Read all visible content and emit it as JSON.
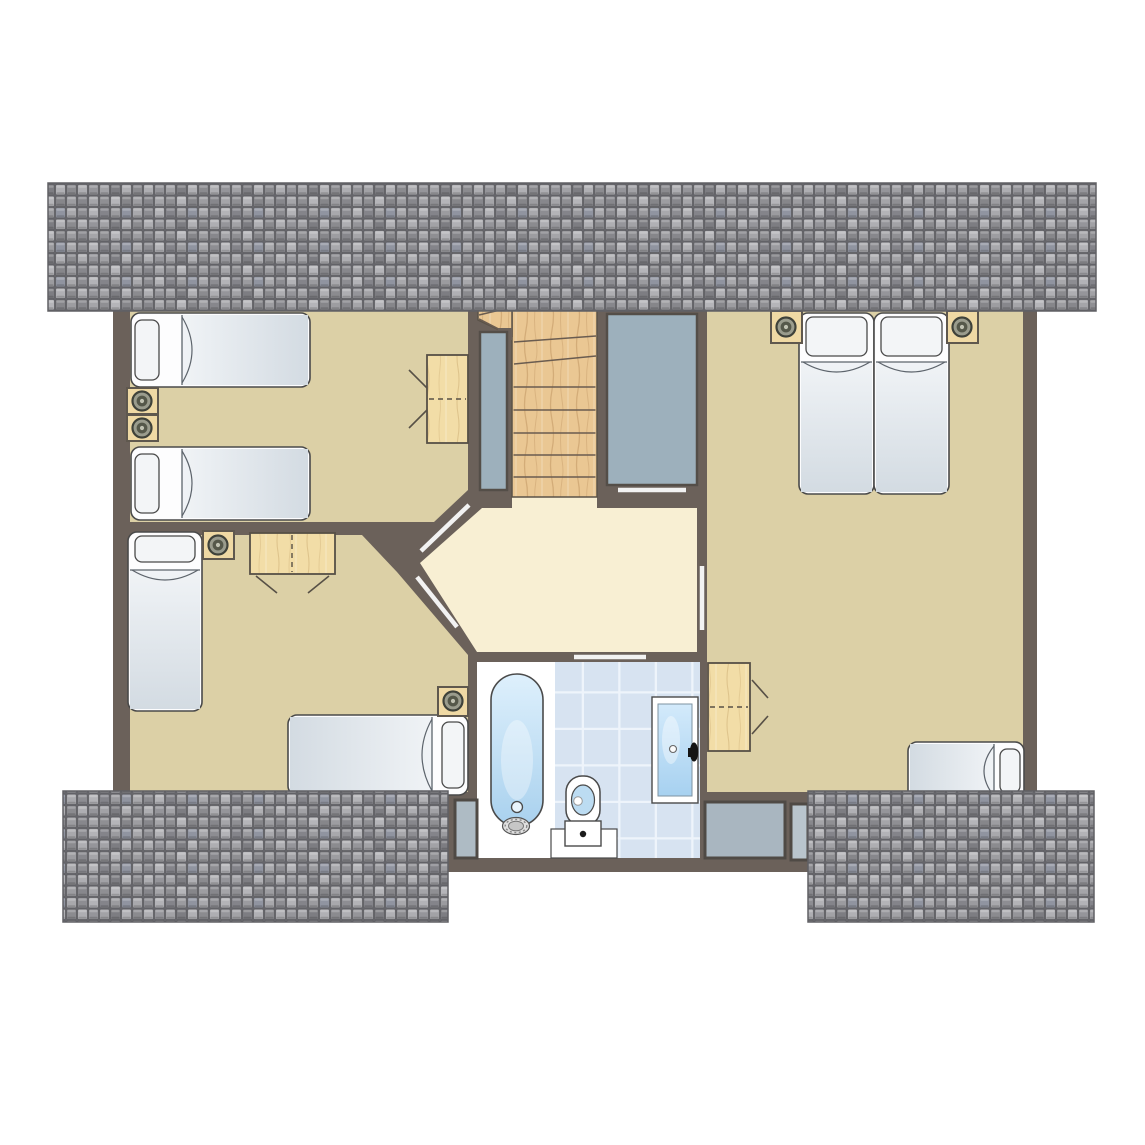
{
  "canvas": {
    "width": 1145,
    "height": 1145,
    "background": "#ffffff"
  },
  "colors": {
    "wall": "#6b615a",
    "room": "#dcd0a6",
    "hall": "#f8efd3",
    "panel": "#9db0bc",
    "panelStroke": "#544e48",
    "outline": "#4a4a4a",
    "woodStroke": "#5a5248",
    "furnitureWood": "#efd9a4",
    "furnitureStroke": "#5f584e",
    "doorLeaf": "#f2f2f2",
    "treadLine": "#6a5c50",
    "windowGlass": "#a9b6c0",
    "tileBase": "#d7e3f1",
    "tileGrout": "#eef4fb",
    "roofEdge": "#606065"
  },
  "elements": [
    {
      "k": "rect",
      "n": "building-base",
      "x": 113,
      "y": 298,
      "w": 924,
      "h": 494,
      "f": "wall"
    },
    {
      "k": "rect",
      "n": "bathroom-dormer-base",
      "x": 448,
      "y": 652,
      "w": 367,
      "h": 220,
      "f": "wall"
    },
    {
      "k": "poly",
      "n": "bedroom-top-left-floor",
      "pts": "130,310 468,310 468,490 434,522 130,522",
      "f": "room"
    },
    {
      "k": "poly",
      "n": "bedroom-bottom-left-floor",
      "pts": "130,535 362,535 397,572 468,655 468,792 130,792",
      "f": "room"
    },
    {
      "k": "rect",
      "n": "bedroom-right-floor",
      "x": 707,
      "y": 310,
      "w": 316,
      "h": 482,
      "f": "room"
    },
    {
      "k": "poly",
      "n": "landing-floor",
      "pts": "482,508 697,508 697,652 477,652 420,563",
      "f": "hall"
    },
    {
      "k": "rect",
      "n": "stairs-landing-connector",
      "x": 512,
      "y": 497,
      "w": 85,
      "h": 13,
      "f": "hall"
    },
    {
      "k": "rect",
      "n": "staircase",
      "x": 512,
      "y": 310,
      "w": 85,
      "h": 187,
      "f": "url(#woodS)",
      "s": "woodStroke",
      "sw": 1.5
    },
    {
      "k": "poly",
      "n": "staircase-winder-extension",
      "pts": "478,310 512,310 512,336 478,320",
      "f": "url(#woodS)",
      "s": "woodStroke",
      "sw": 1.5
    },
    {
      "k": "line",
      "n": "stair-tread-1",
      "x1": 513.5,
      "y1": 477,
      "x2": 595.5,
      "y2": 477,
      "s": "treadLine",
      "sw": 1.6
    },
    {
      "k": "line",
      "n": "stair-tread-2",
      "x1": 513.5,
      "y1": 455,
      "x2": 595.5,
      "y2": 455,
      "s": "treadLine",
      "sw": 1.6
    },
    {
      "k": "line",
      "n": "stair-tread-3",
      "x1": 513.5,
      "y1": 433,
      "x2": 595.5,
      "y2": 433,
      "s": "treadLine",
      "sw": 1.6
    },
    {
      "k": "line",
      "n": "stair-tread-4",
      "x1": 513.5,
      "y1": 410,
      "x2": 595.5,
      "y2": 410,
      "s": "treadLine",
      "sw": 1.6
    },
    {
      "k": "line",
      "n": "stair-tread-5",
      "x1": 513.5,
      "y1": 387,
      "x2": 595.5,
      "y2": 387,
      "s": "treadLine",
      "sw": 1.6
    },
    {
      "k": "line",
      "n": "stair-winder-1",
      "x1": 514,
      "y1": 364,
      "x2": 596,
      "y2": 356,
      "s": "treadLine",
      "sw": 1.6
    },
    {
      "k": "line",
      "n": "stair-winder-2",
      "x1": 514,
      "y1": 342,
      "x2": 596,
      "y2": 336,
      "s": "treadLine",
      "sw": 1.6
    },
    {
      "k": "line",
      "n": "stair-winder-3",
      "x1": 512,
      "y1": 336,
      "x2": 479,
      "y2": 319,
      "s": "treadLine",
      "sw": 1.6
    },
    {
      "k": "line",
      "n": "stair-winder-4",
      "x1": 500,
      "y1": 310,
      "x2": 479,
      "y2": 315,
      "s": "treadLine",
      "sw": 1.6
    },
    {
      "k": "rect",
      "n": "stair-wall-stub",
      "x": 498,
      "y": 328,
      "w": 14,
      "h": 12,
      "f": "wall"
    },
    {
      "k": "rect",
      "n": "void-panel",
      "x": 480,
      "y": 332,
      "w": 27,
      "h": 158,
      "f": "panel",
      "s": "panelStroke",
      "sw": 2.5
    },
    {
      "k": "rect",
      "n": "closet",
      "x": 607,
      "y": 314,
      "w": 90,
      "h": 171,
      "f": "panel",
      "s": "panelStroke",
      "sw": 2.5
    },
    {
      "k": "rect",
      "n": "bathroom-wet-floor",
      "x": 477,
      "y": 662,
      "w": 78,
      "h": 196,
      "f": "#ffffff"
    },
    {
      "k": "rect",
      "n": "bathroom-tile-floor",
      "x": 555,
      "y": 662,
      "w": 145,
      "h": 196,
      "f": "url(#btiles)"
    },
    {
      "k": "rect",
      "n": "toilet-base-block",
      "x": 551,
      "y": 829,
      "w": 66,
      "h": 29,
      "f": "#ffffff",
      "s": "outline",
      "sw": 1.2
    },
    {
      "k": "rect",
      "n": "dormer-window-left",
      "x": 455,
      "y": 800,
      "w": 22,
      "h": 58,
      "f": "#aebbc4",
      "s": "#4f4a45",
      "sw": 3
    },
    {
      "k": "rect",
      "n": "dormer-window-right-1",
      "x": 705,
      "y": 802,
      "w": 80,
      "h": 56,
      "f": "windowGlass",
      "s": "#4f4a45",
      "sw": 3
    },
    {
      "k": "rect",
      "n": "dormer-window-right-2",
      "x": 791,
      "y": 804,
      "w": 17,
      "h": 56,
      "f": "#b9c5cd",
      "s": "#4f4a45",
      "sw": 3
    },
    {
      "k": "line",
      "n": "door-bedroom-top-left",
      "x1": 469,
      "y1": 505,
      "x2": 421,
      "y2": 551,
      "s": "doorLeaf",
      "sw": 4.5
    },
    {
      "k": "line",
      "n": "door-bedroom-bottom-left",
      "x1": 417,
      "y1": 577,
      "x2": 457,
      "y2": 627,
      "s": "doorLeaf",
      "sw": 4.5
    },
    {
      "k": "line",
      "n": "door-bedroom-right",
      "x1": 702,
      "y1": 566,
      "x2": 702,
      "y2": 630,
      "s": "doorLeaf",
      "sw": 4.5
    },
    {
      "k": "line",
      "n": "door-closet",
      "x1": 618,
      "y1": 490,
      "x2": 686,
      "y2": 490,
      "s": "doorLeaf",
      "sw": 4.5
    },
    {
      "k": "line",
      "n": "door-bathroom",
      "x1": 574,
      "y1": 657,
      "x2": 646,
      "y2": 657,
      "s": "doorLeaf",
      "sw": 4.5
    },
    {
      "k": "bed",
      "n": "bed-single-1",
      "x": 131,
      "y": 313,
      "w": 179,
      "h": 74,
      "dir": "left",
      "pt": 24,
      "ho": 51
    },
    {
      "k": "bed",
      "n": "bed-single-2",
      "x": 131,
      "y": 447,
      "w": 179,
      "h": 73,
      "dir": "left",
      "pt": 24,
      "ho": 51
    },
    {
      "k": "bed",
      "n": "bed-single-3",
      "x": 128,
      "y": 532,
      "w": 74,
      "h": 179,
      "dir": "top",
      "pt": 26,
      "ho": 38
    },
    {
      "k": "bed",
      "n": "bed-single-4",
      "x": 288,
      "y": 715,
      "w": 180,
      "h": 80,
      "dir": "right",
      "pt": 22,
      "ho": 36
    },
    {
      "k": "bed",
      "n": "bed-double-left",
      "x": 799,
      "y": 313,
      "w": 75,
      "h": 181,
      "dir": "top",
      "pt": 39,
      "ho": 49
    },
    {
      "k": "bed",
      "n": "bed-double-right",
      "x": 874,
      "y": 313,
      "w": 75,
      "h": 181,
      "dir": "top",
      "pt": 39,
      "ho": 49
    },
    {
      "k": "bed",
      "n": "bed-single-5",
      "x": 908,
      "y": 742,
      "w": 116,
      "h": 58,
      "dir": "right",
      "pt": 20,
      "ho": 30
    },
    {
      "k": "rect",
      "n": "nightstand-1",
      "x": 127,
      "y": 388,
      "w": 31,
      "h": 26,
      "f": "furnitureWood",
      "s": "furnitureStroke",
      "sw": 2
    },
    {
      "k": "lamp",
      "n": "lamp-1",
      "cx": 142,
      "cy": 401
    },
    {
      "k": "rect",
      "n": "nightstand-2",
      "x": 127,
      "y": 415,
      "w": 31,
      "h": 26,
      "f": "furnitureWood",
      "s": "furnitureStroke",
      "sw": 2
    },
    {
      "k": "lamp",
      "n": "lamp-2",
      "cx": 142,
      "cy": 428
    },
    {
      "k": "rect",
      "n": "nightstand-3",
      "x": 203,
      "y": 531,
      "w": 31,
      "h": 28,
      "f": "furnitureWood",
      "s": "furnitureStroke",
      "sw": 2
    },
    {
      "k": "lamp",
      "n": "lamp-3",
      "cx": 218,
      "cy": 545
    },
    {
      "k": "rect",
      "n": "nightstand-4",
      "x": 438,
      "y": 687,
      "w": 30,
      "h": 29,
      "f": "furnitureWood",
      "s": "furnitureStroke",
      "sw": 2
    },
    {
      "k": "lamp",
      "n": "lamp-4",
      "cx": 453,
      "cy": 701
    },
    {
      "k": "rect",
      "n": "nightstand-5",
      "x": 771,
      "y": 311,
      "w": 31,
      "h": 32,
      "f": "furnitureWood",
      "s": "furnitureStroke",
      "sw": 2
    },
    {
      "k": "lamp",
      "n": "lamp-5",
      "cx": 786,
      "cy": 327
    },
    {
      "k": "rect",
      "n": "nightstand-6",
      "x": 947,
      "y": 311,
      "w": 31,
      "h": 32,
      "f": "furnitureWood",
      "s": "furnitureStroke",
      "sw": 2
    },
    {
      "k": "lamp",
      "n": "lamp-6",
      "cx": 962,
      "cy": 327
    },
    {
      "k": "rect",
      "n": "desk-1",
      "x": 427,
      "y": 355,
      "w": 41,
      "h": 88,
      "f": "url(#woodD)",
      "s": "#575046",
      "sw": 1.8
    },
    {
      "k": "line",
      "n": "desk-1-foldline",
      "x1": 429,
      "y1": 399,
      "x2": 466,
      "y2": 399,
      "s": "#575046",
      "sw": 1.4,
      "dash": "5,4"
    },
    {
      "k": "line",
      "n": "chair-1-line-a",
      "x1": 409,
      "y1": 370,
      "x2": 427,
      "y2": 388,
      "s": "#575046",
      "sw": 1.6
    },
    {
      "k": "line",
      "n": "chair-1-line-b",
      "x1": 409,
      "y1": 428,
      "x2": 427,
      "y2": 410,
      "s": "#575046",
      "sw": 1.6
    },
    {
      "k": "rect",
      "n": "desk-2",
      "x": 250,
      "y": 533,
      "w": 85,
      "h": 41,
      "f": "url(#woodD)",
      "s": "#575046",
      "sw": 1.8
    },
    {
      "k": "line",
      "n": "desk-2-foldline",
      "x1": 292,
      "y1": 535,
      "x2": 292,
      "y2": 572,
      "s": "#575046",
      "sw": 1.4,
      "dash": "5,4"
    },
    {
      "k": "line",
      "n": "chair-2-line-a",
      "x1": 256,
      "y1": 576,
      "x2": 277,
      "y2": 593,
      "s": "#575046",
      "sw": 1.6
    },
    {
      "k": "line",
      "n": "chair-2-line-b",
      "x1": 329,
      "y1": 576,
      "x2": 308,
      "y2": 593,
      "s": "#575046",
      "sw": 1.6
    },
    {
      "k": "rect",
      "n": "desk-3",
      "x": 708,
      "y": 663,
      "w": 42,
      "h": 88,
      "f": "url(#woodD)",
      "s": "#575046",
      "sw": 1.8
    },
    {
      "k": "line",
      "n": "desk-3-foldline",
      "x1": 710,
      "y1": 707,
      "x2": 748,
      "y2": 707,
      "s": "#575046",
      "sw": 1.4,
      "dash": "5,4"
    },
    {
      "k": "line",
      "n": "chair-3-line-a",
      "x1": 752,
      "y1": 680,
      "x2": 768,
      "y2": 698,
      "s": "#575046",
      "sw": 1.6
    },
    {
      "k": "line",
      "n": "chair-3-line-b",
      "x1": 752,
      "y1": 734,
      "x2": 768,
      "y2": 716,
      "s": "#575046",
      "sw": 1.6
    },
    {
      "k": "rect",
      "n": "bathtub",
      "x": 491,
      "y": 674,
      "w": 52,
      "h": 152,
      "rx": 26,
      "f": "url(#tubg)",
      "s": "outline",
      "sw": 1.6
    },
    {
      "k": "ellipse",
      "n": "bathtub-glow",
      "cx": 517,
      "cy": 760,
      "rx": 16,
      "ry": 40,
      "f": "#ffffff",
      "o": 0.35
    },
    {
      "k": "circle",
      "n": "bathtub-overflow",
      "cx": 517,
      "cy": 807,
      "r": 5.5,
      "f": "#e9f4fc",
      "s": "outline",
      "sw": 1.3
    },
    {
      "k": "ellipse",
      "n": "bathtub-faucet-outer",
      "cx": 516,
      "cy": 826,
      "rx": 13.5,
      "ry": 8.5,
      "f": "#e0e0e0",
      "s": "#555555",
      "sw": 1.2
    },
    {
      "k": "ellipse",
      "n": "bathtub-faucet-ring",
      "cx": 516,
      "cy": 826,
      "rx": 10.8,
      "ry": 6.6,
      "f": "none",
      "s": "#888888",
      "sw": 1.4,
      "dash": "2,2.5"
    },
    {
      "k": "ellipse",
      "n": "bathtub-faucet-inner",
      "cx": 516,
      "cy": 826,
      "rx": 7.5,
      "ry": 4.8,
      "f": "#c6c6c6",
      "s": "#777777",
      "sw": 1
    },
    {
      "k": "rect",
      "n": "toilet-seat",
      "x": 566,
      "y": 776,
      "w": 34,
      "h": 50,
      "rx": 16,
      "f": "#ffffff",
      "s": "outline",
      "sw": 1.5
    },
    {
      "k": "ellipse",
      "n": "toilet-bowl",
      "cx": 583,
      "cy": 800,
      "rx": 11.5,
      "ry": 15,
      "f": "#bcdcf2",
      "s": "outline",
      "sw": 1.2
    },
    {
      "k": "circle",
      "n": "toilet-flush",
      "cx": 578,
      "cy": 801,
      "r": 4.3,
      "f": "#ffffff",
      "s": "#999999",
      "sw": 1
    },
    {
      "k": "rect",
      "n": "toilet-tank",
      "x": 565,
      "y": 821,
      "w": 36,
      "h": 25,
      "f": "#ffffff",
      "s": "outline",
      "sw": 1.4
    },
    {
      "k": "circle",
      "n": "toilet-tank-button",
      "cx": 583,
      "cy": 834,
      "r": 3.2,
      "f": "#1c1c1c"
    },
    {
      "k": "rect",
      "n": "glass-door-frame",
      "x": 652,
      "y": 697,
      "w": 46,
      "h": 106,
      "f": "#ffffff",
      "s": "outline",
      "sw": 1.4
    },
    {
      "k": "rect",
      "n": "glass-door-pane",
      "x": 658,
      "y": 704,
      "w": 34,
      "h": 92,
      "f": "url(#glassg)",
      "s": "#7e93a2",
      "sw": 1
    },
    {
      "k": "ellipse",
      "n": "glass-door-shine",
      "cx": 671,
      "cy": 740,
      "rx": 9,
      "ry": 24,
      "f": "#ffffff",
      "o": 0.4
    },
    {
      "k": "circle",
      "n": "glass-door-knob",
      "cx": 673,
      "cy": 749,
      "r": 3.5,
      "f": "#fbfbfb",
      "s": "#666666",
      "sw": 1.1
    },
    {
      "k": "ellipse",
      "n": "glass-door-handle",
      "cx": 694,
      "cy": 752,
      "rx": 4.2,
      "ry": 9.5,
      "f": "#141414"
    },
    {
      "k": "rect",
      "n": "glass-door-handle-base",
      "x": 688,
      "y": 748,
      "w": 6,
      "h": 9,
      "f": "#141414"
    },
    {
      "k": "rect",
      "n": "roof-top",
      "x": 48,
      "y": 183,
      "w": 1048,
      "h": 128,
      "f": "url(#shingles)",
      "s": "roofEdge",
      "sw": 1.5
    },
    {
      "k": "rect",
      "n": "roof-bottom-left",
      "x": 63,
      "y": 791,
      "w": 385,
      "h": 131,
      "f": "url(#shingles)",
      "s": "roofEdge",
      "sw": 1.5
    },
    {
      "k": "rect",
      "n": "roof-bottom-right",
      "x": 808,
      "y": 791,
      "w": 286,
      "h": 131,
      "f": "url(#shingles)",
      "s": "roofEdge",
      "sw": 1.5
    }
  ]
}
